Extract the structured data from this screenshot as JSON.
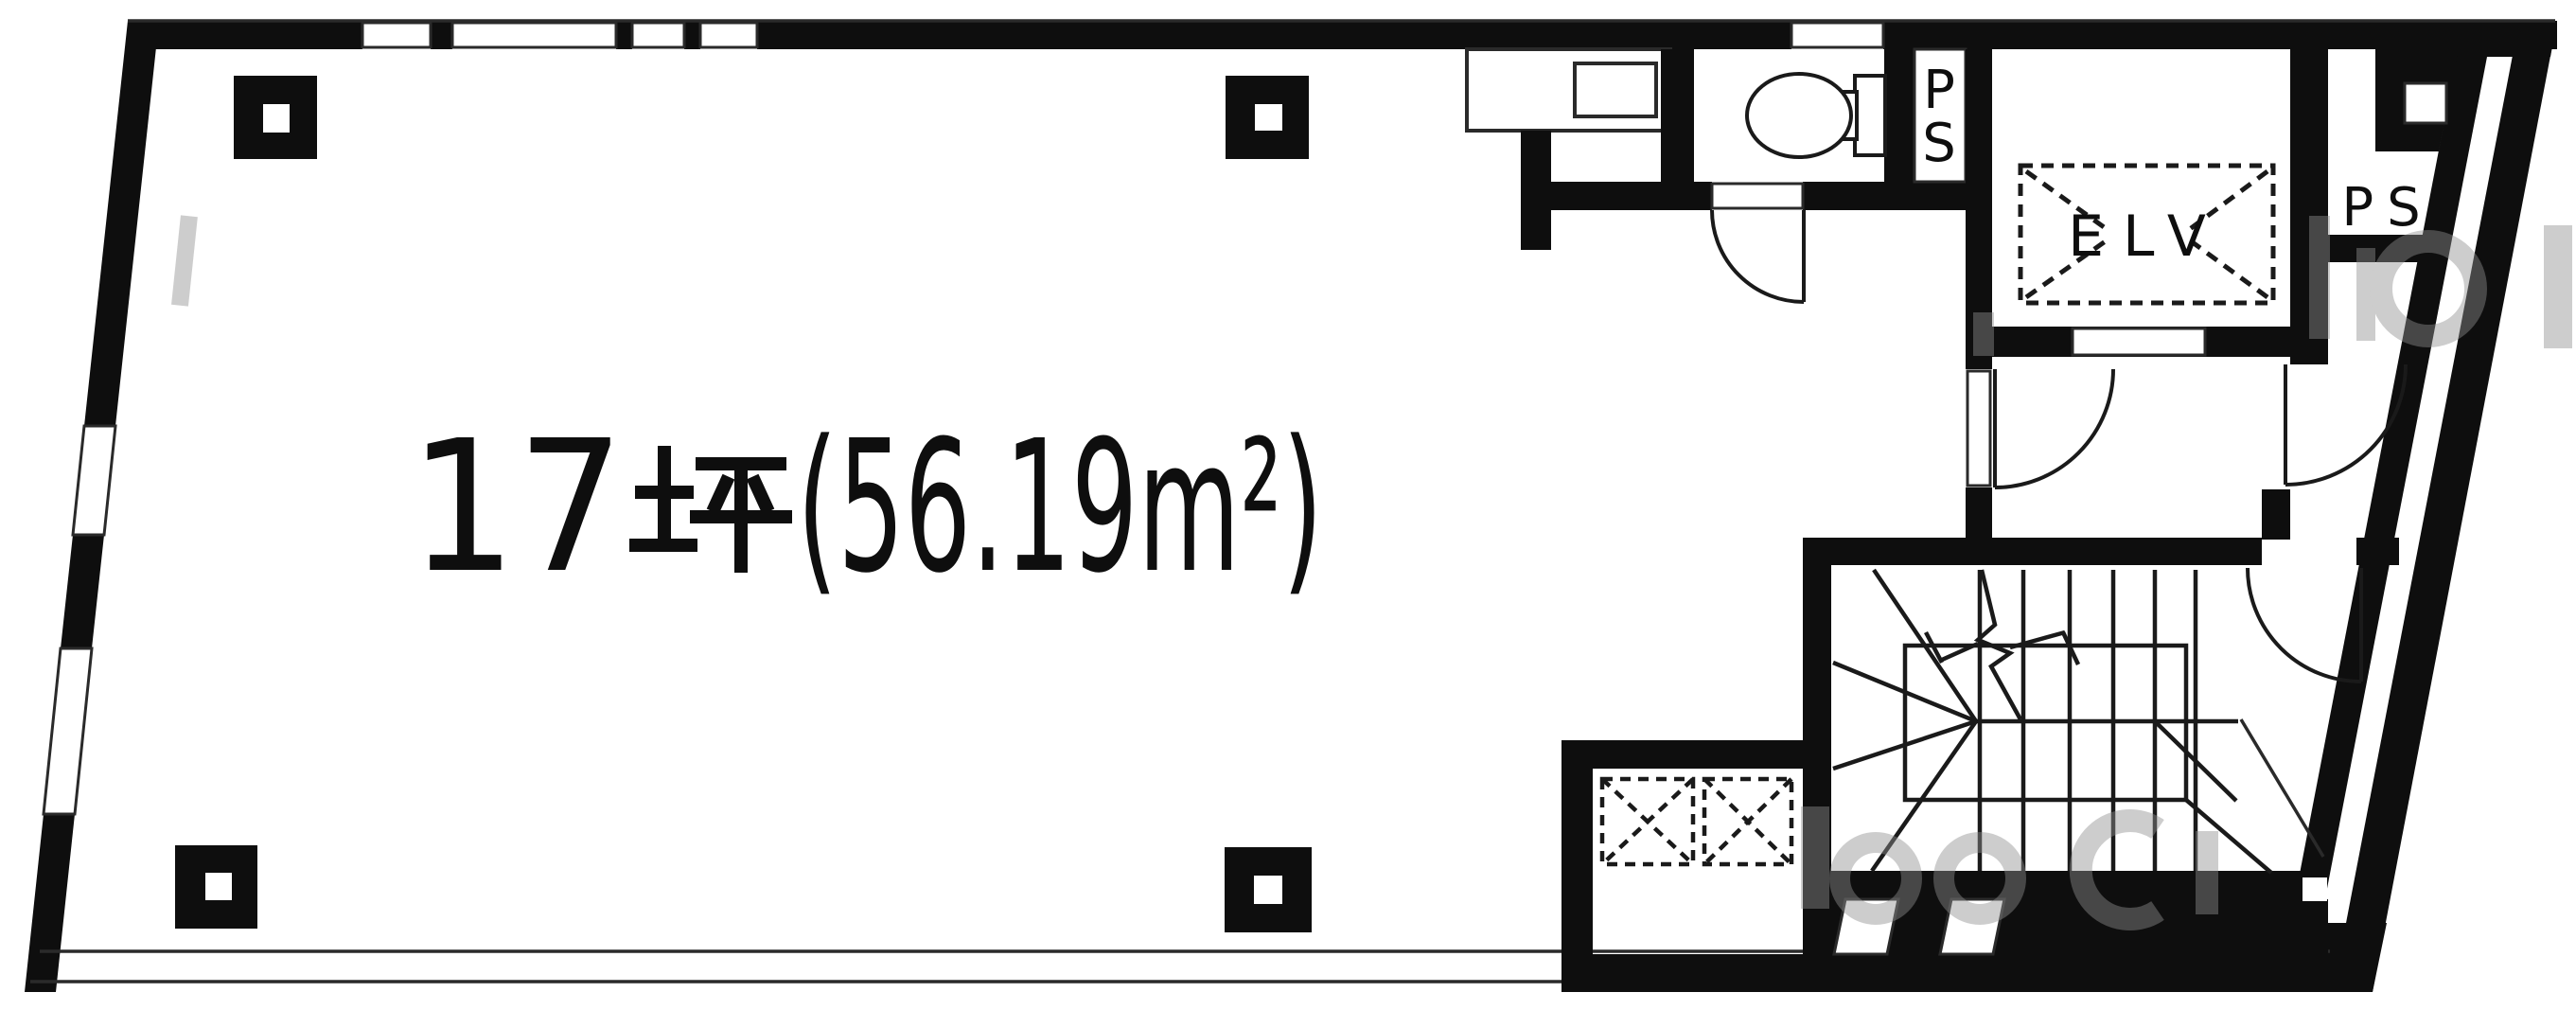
{
  "floor_plan": {
    "area_label": "17坪(56.19m²)",
    "area_label_parts": {
      "prefix": "17",
      "tsubo": "坪",
      "suffix": "(56.19m²)"
    },
    "labels": {
      "elevator": "ELV",
      "pipe_shaft_top_letters": [
        "P",
        "S"
      ],
      "pipe_shaft_right": "PS"
    },
    "colors": {
      "ink": "#0e0e0e",
      "thin_line": "#2a2a2a",
      "paper": "#ffffff",
      "watermark": "#8f8f8f"
    }
  }
}
